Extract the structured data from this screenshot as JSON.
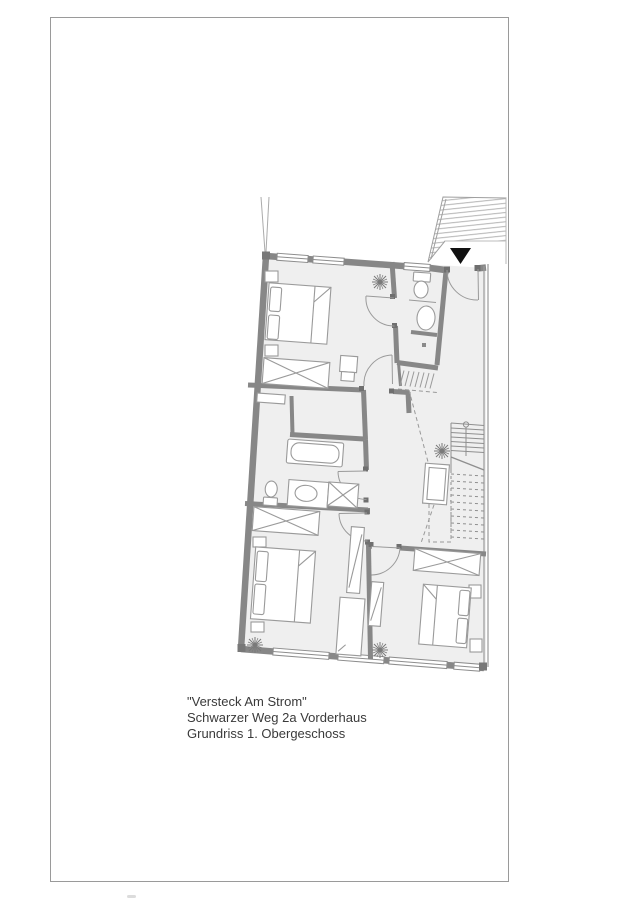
{
  "document": {
    "type": "architectural floor plan sheet",
    "background": "#ffffff"
  },
  "frame": {
    "border_color": "#9a9a9a"
  },
  "caption": {
    "line1": "\"Versteck Am Strom\"",
    "line2": "Schwarzer Weg 2a Vorderhaus",
    "line3": "Grundriss 1. Obergeschoss"
  },
  "colors": {
    "wall": "#878787",
    "wall_dark": "#6f6f6f",
    "floor": "#efefef",
    "furniture_line": "#9a9a9a",
    "dashed_line": "#999999",
    "hatch_line": "#b3b3b3",
    "plant": "#7a7a7a",
    "entrance_marker": "#111111",
    "text": "#3a3a3a",
    "frame_border": "#9a9a9a"
  },
  "icons": {
    "entrance_marker": "▼",
    "plant": "radiating-lines asterisk",
    "wardrobe": "rectangle with X cross",
    "stair": "parallel tread lines"
  }
}
